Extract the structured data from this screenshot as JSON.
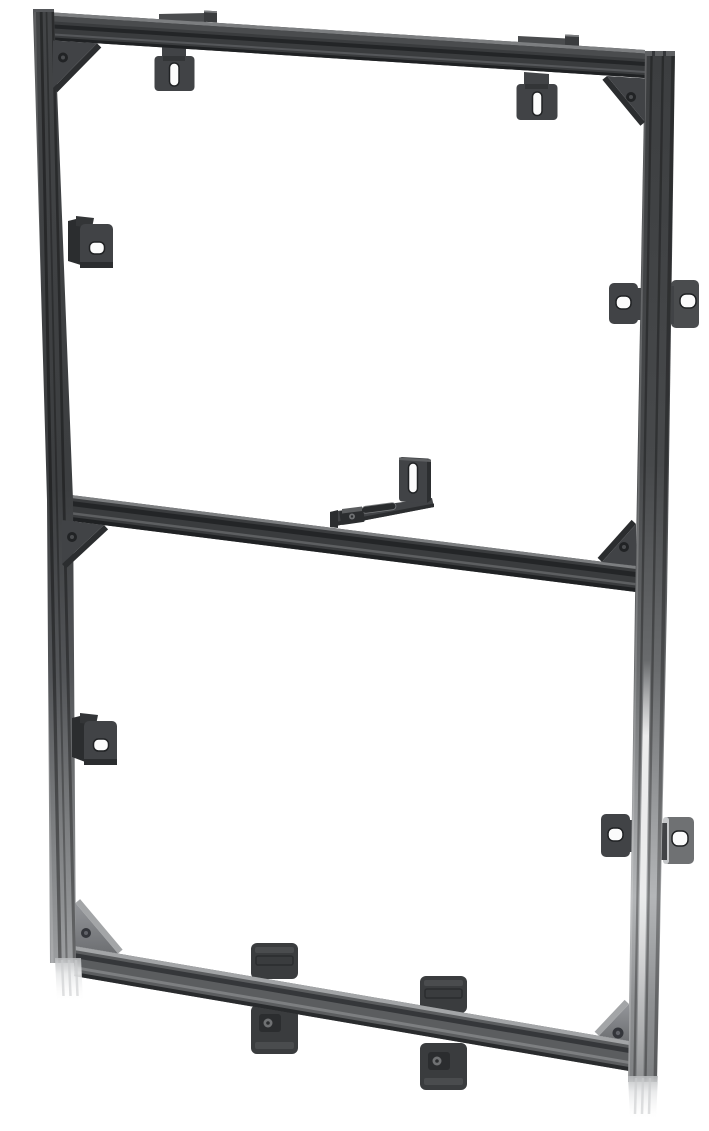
{
  "meta": {
    "alt": "3D render of a black aluminium-extrusion mounting frame with corner gussets, slotted hanger brackets, side hook brackets, dual-ear wall brackets, strap clips and white end-cap feet",
    "background": "#ffffff"
  },
  "palette": {
    "background": "#ffffff",
    "frame_dark": "#3a3c3e",
    "frame_mid": "#4a4c4e",
    "groove_dark": "#232527",
    "edge_light": "#7c7e80",
    "rail_bottom_dark": "#1f2123",
    "bracket_dark": "#414346",
    "bracket_deep": "#2b2d2f",
    "bracket_tab": "#333537",
    "metal_mid": "#6f7173",
    "metal_light": "#a3a5a7",
    "metal_bright": "#c6c8ca",
    "hole_dark": "#212325",
    "hole_inner": "#4b4d50",
    "hole_ring": "#202224",
    "slot_white": "#fbfbfb",
    "slot_recessed": "#2a2c2e",
    "foot_gray": "#c9cbcd",
    "specular": "#ffffff"
  },
  "parts": {
    "rails": [
      "top-rail",
      "middle-crossbar",
      "bottom-rail",
      "left-rail",
      "right-rail"
    ],
    "gussets": [
      "top-left",
      "top-right",
      "middle-left",
      "middle-right",
      "bottom-left",
      "bottom-right"
    ],
    "brackets": [
      "top-clamp-tab-left",
      "top-clamp-tab-right",
      "slotted-hanger-left",
      "slotted-hanger-right",
      "side-hook-upper",
      "side-hook-lower",
      "dual-ear-wall-upper",
      "dual-ear-wall-lower",
      "center-arm-bracket",
      "strap-clip-left",
      "strap-clip-right"
    ],
    "feet": [
      "left-end-cap-foot",
      "right-end-cap-foot"
    ]
  }
}
